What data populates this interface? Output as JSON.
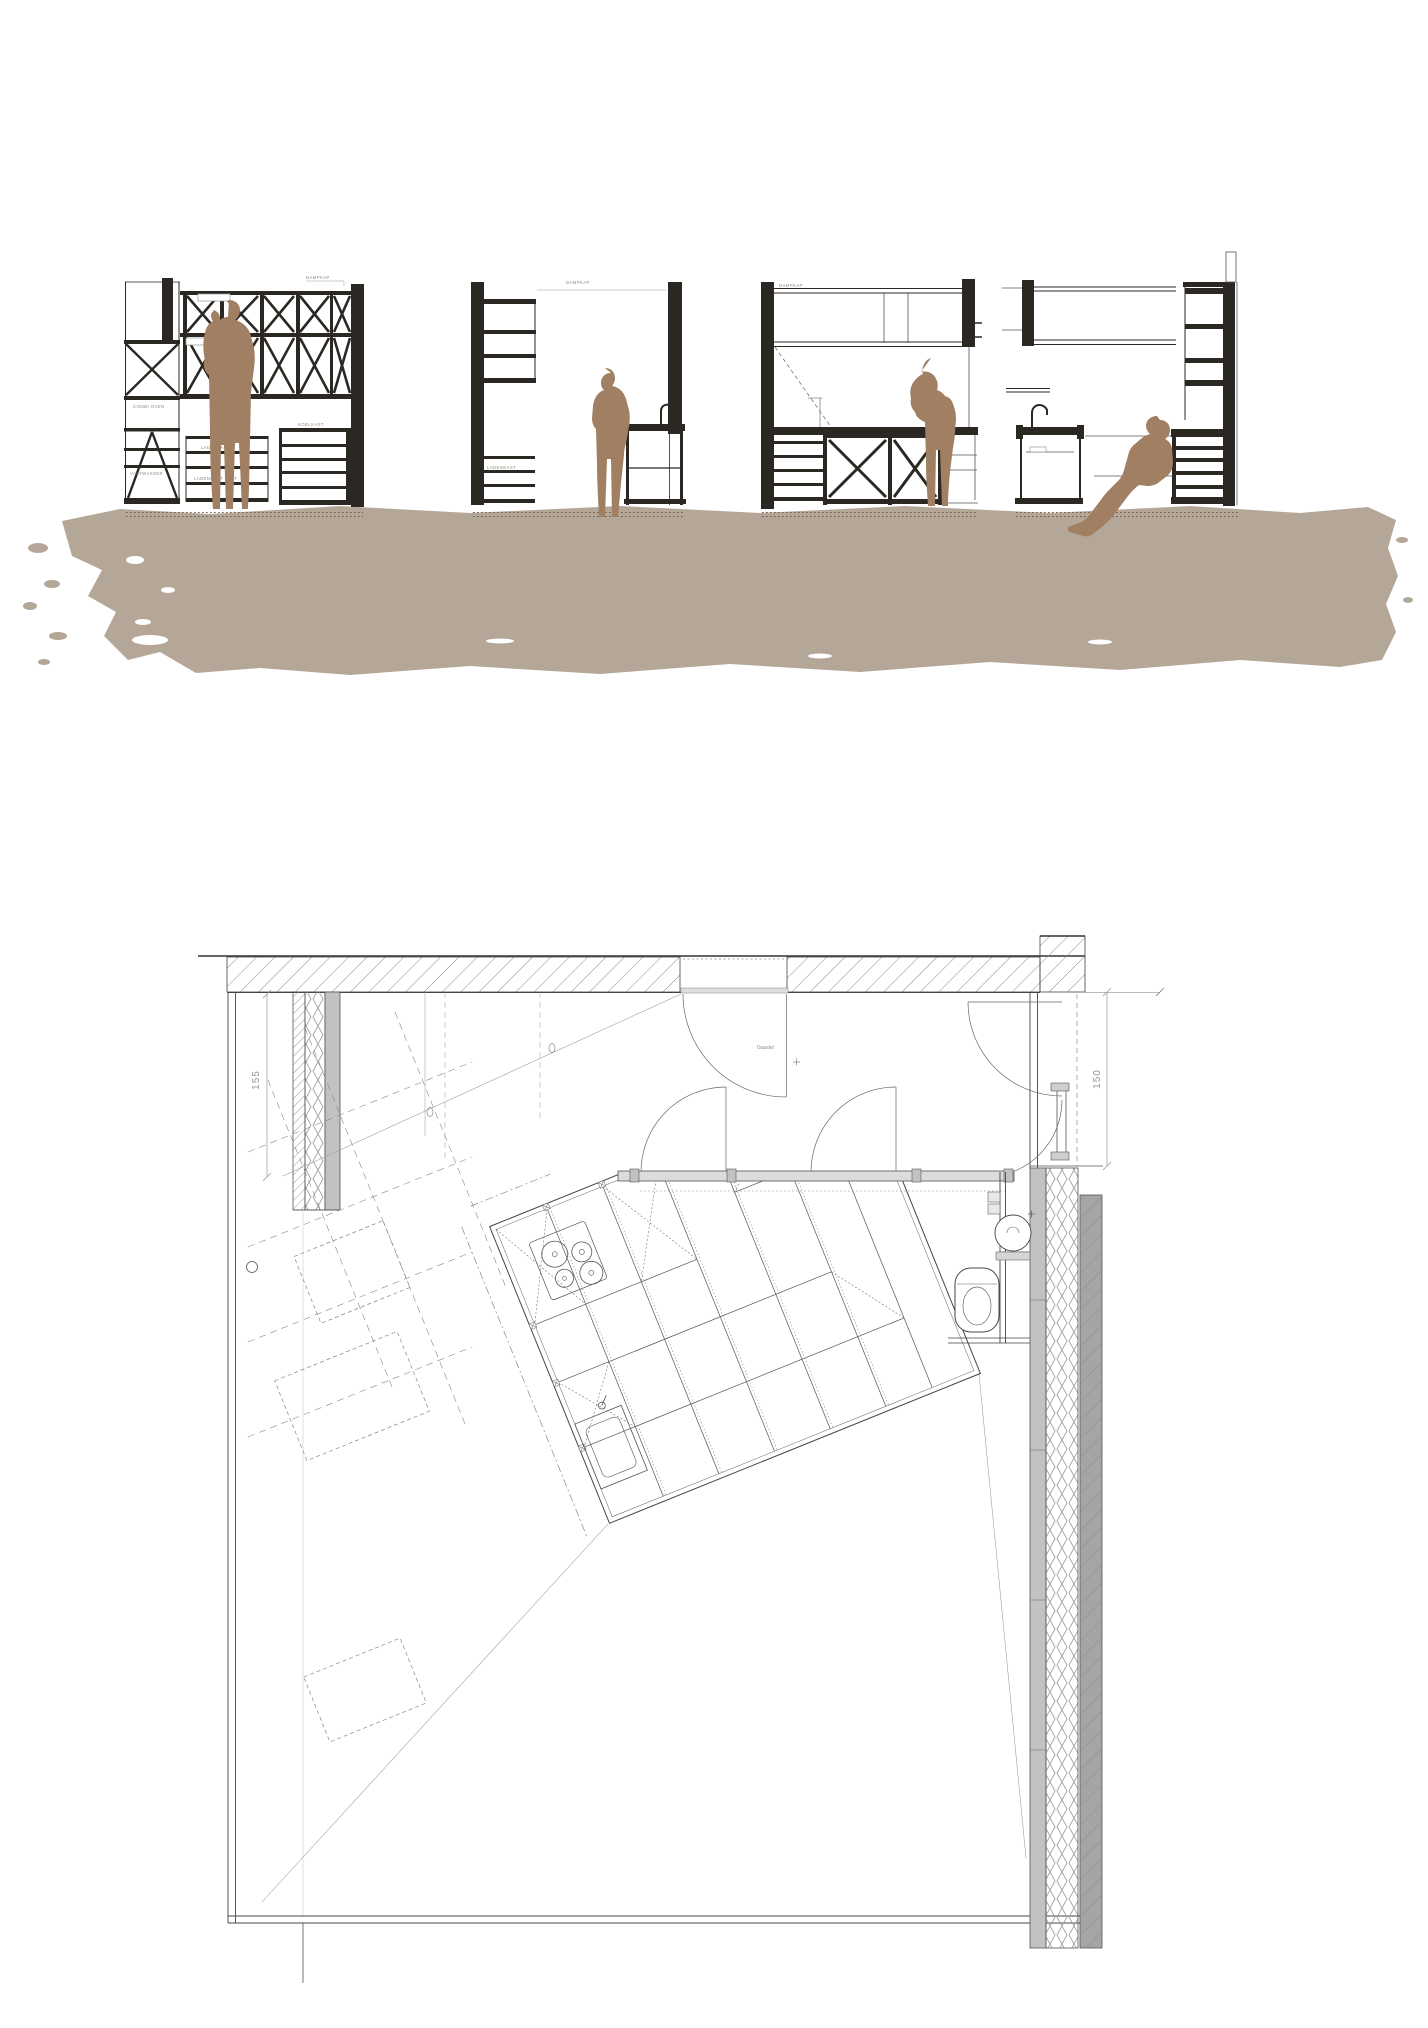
{
  "drawing": {
    "type": "architectural kitchen sections and floor plan",
    "colors": {
      "ink": "#2b2824",
      "figure": "#a07f62",
      "ground_wash": "#b4a798",
      "wall_gray": "#c2c2c2",
      "plan_line": "#4d4d4d"
    },
    "sections": {
      "panel_a": {
        "hood_label": "DAMPKAP",
        "oven_label": "COMBI OVEN",
        "dishwasher_label": "VAATWASSER",
        "drawer_label_1": "LADENKAST",
        "drawer_label_2": "LADENKAST VAST",
        "fridge_label": "KOELKAST"
      },
      "panel_b": {
        "hood_label": "DAMPKAP",
        "drawer_label": "LADENKAST"
      },
      "panel_c": {
        "hood_label": "DAMPKAP"
      }
    },
    "plan": {
      "dim_left": "155",
      "dim_right": "150",
      "gas_label": "Gasstel"
    }
  }
}
